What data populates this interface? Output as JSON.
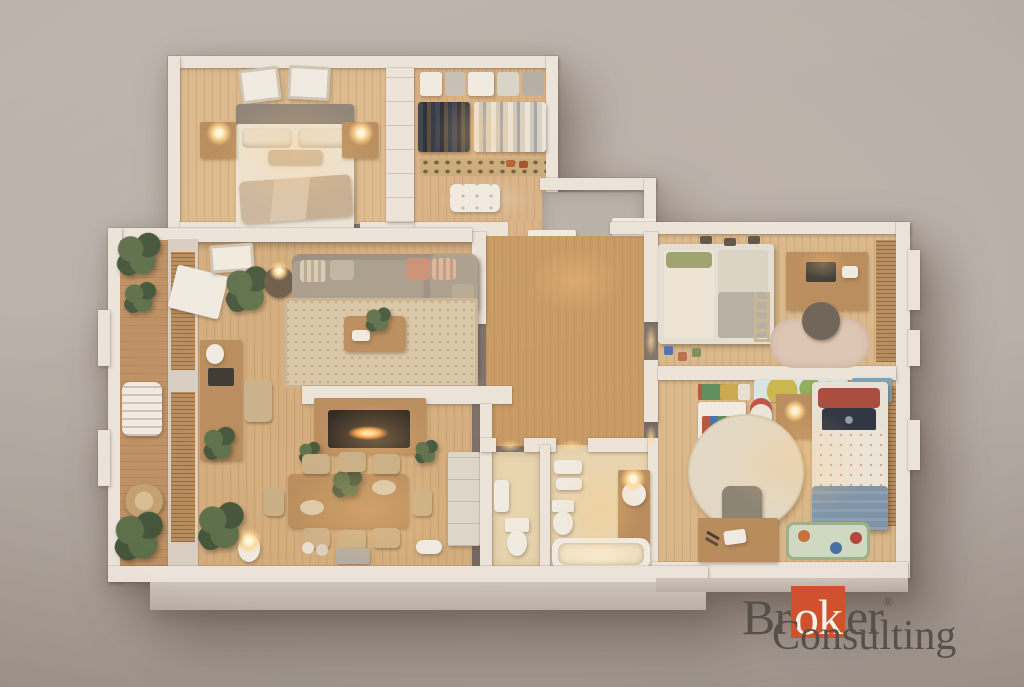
{
  "watermark": {
    "brand_pre": "Br",
    "brand_highlight": "ok",
    "brand_post": "er",
    "registered": "®",
    "brand_line2": "Consulting"
  },
  "palette": {
    "bg_top": "#b9b0a9",
    "bg_bottom": "#a29890",
    "wall": "#ebe3d9",
    "wall_dim": "#d7cdc1",
    "wall_face": "#cdc3b7",
    "floor_master": "#dcb98c",
    "floor_closet": "#d8b083",
    "floor_living": "#d3ac7c",
    "floor_hall": "#c69760",
    "floor_kids": "#d9b688",
    "floor_bath": "#e7d4ae",
    "floor_entry": "#b6aea6",
    "deck": "#bd9063",
    "rug_living": "#d8c5a5",
    "rug_round": "#e2d7c3",
    "rug_kids": "#dcc5b2",
    "sofa": "#a79b8a",
    "sofa_dark": "#918574",
    "wood": "#b88b5b",
    "wood_dark": "#7c5f3c",
    "white_obj": "#f0eae0",
    "closet_dark": "#342e2a",
    "plant": "#5d6f4a",
    "plant_dark": "#44553a",
    "fire": "#ff9c3e",
    "kids_blue": "#7f94a7",
    "kids_red": "#a84a3c",
    "duvet": "#ece4d6",
    "map_blue": "#d7e6e6",
    "logo_text": "#57504a",
    "logo_accent": "#d0512e",
    "logo_white": "#f8f2ea"
  },
  "scene": {
    "type": "3d-floor-plan-render",
    "rooms": [
      "master-bedroom",
      "walk-in-closet",
      "entry-hall",
      "hallway",
      "living-room",
      "dining-area",
      "home-office-nook",
      "balcony",
      "wc",
      "bathroom",
      "hall-closet",
      "kids-bedroom-bunk",
      "kids-bedroom-single"
    ]
  }
}
